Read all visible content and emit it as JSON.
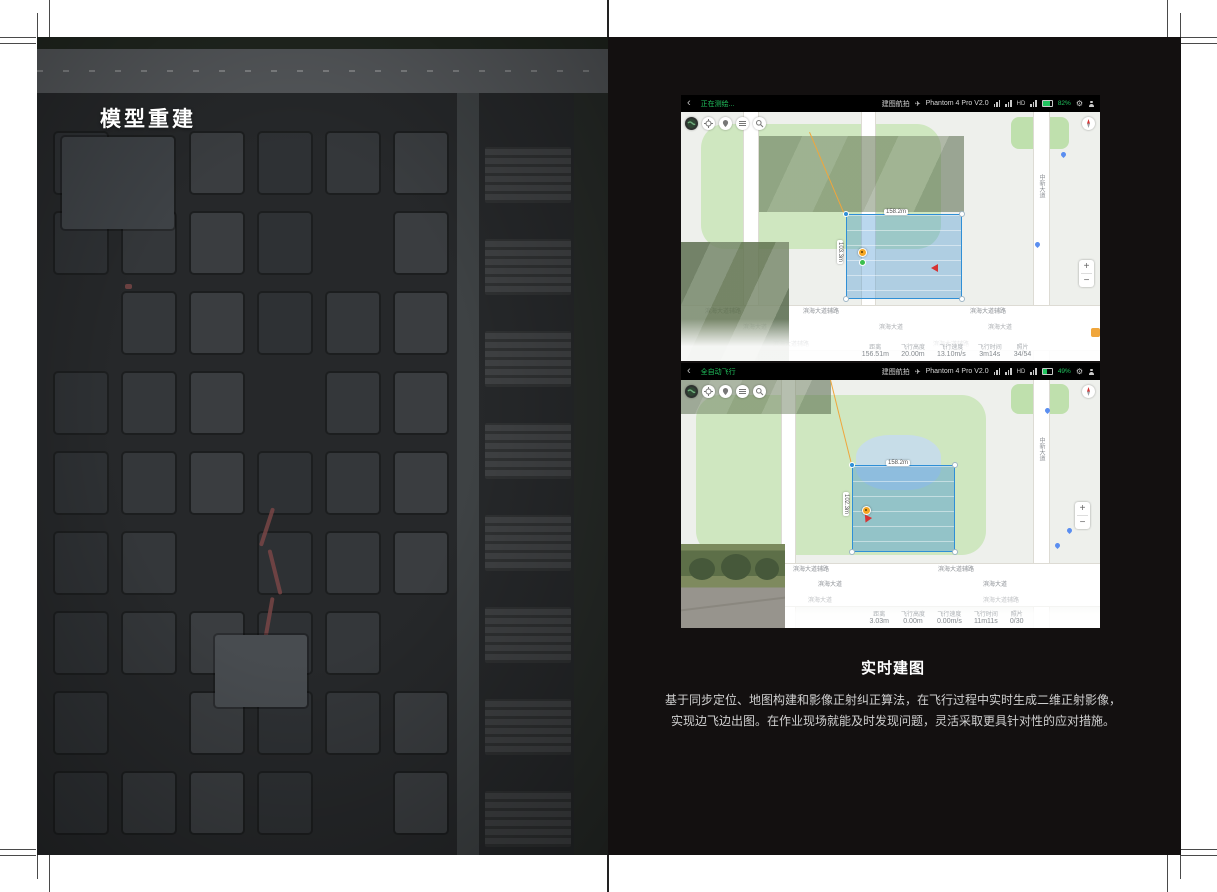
{
  "page": {
    "left_panel": {
      "title": "模型重建"
    },
    "caption": {
      "title": "实时建图",
      "line1": "基于同步定位、地图构建和影像正射纠正算法，在飞行过程中实时生成二维正射影像，",
      "line2": "实现边飞边出图。在作业现场就能及时发现问题，灵活采取更具针对性的应对措施。"
    }
  },
  "icons": {
    "back": "‹",
    "plane": "✈",
    "gear": "⚙",
    "zoom_in": "+",
    "zoom_out": "−"
  },
  "screens": [
    {
      "status": "正在测绘...",
      "mission_type": "建图航拍",
      "device": "Phantom 4 Pro V2.0",
      "hd": "HD",
      "battery": "82%",
      "battery_pct": 82,
      "survey": {
        "width_label": "158.2m",
        "height_label": "103.3m"
      },
      "map": {
        "road_main": "滨海大道",
        "road_side": "滨海大道辅路",
        "road_vertical": "中新大道"
      },
      "telemetry": [
        {
          "label": "距离",
          "value": "156.51m"
        },
        {
          "label": "飞行高度",
          "value": "20.00m"
        },
        {
          "label": "飞行速度",
          "value": "13.10m/s"
        },
        {
          "label": "飞行时间",
          "value": "3m14s"
        },
        {
          "label": "照片",
          "value": "34/54"
        }
      ]
    },
    {
      "status": "全自动飞行",
      "mission_type": "建图航拍",
      "device": "Phantom 4 Pro V2.0",
      "hd": "HD",
      "battery": "49%",
      "battery_pct": 49,
      "survey": {
        "width_label": "158.2m",
        "height_label": "102.3m"
      },
      "map": {
        "road_main": "滨海大道",
        "road_side": "滨海大道辅路",
        "road_vertical": "中新大道"
      },
      "telemetry": [
        {
          "label": "距离",
          "value": "3.03m"
        },
        {
          "label": "飞行高度",
          "value": "0.00m"
        },
        {
          "label": "飞行速度",
          "value": "0.00m/s"
        },
        {
          "label": "飞行时间",
          "value": "11m11s"
        },
        {
          "label": "照片",
          "value": "0/30"
        }
      ]
    }
  ]
}
